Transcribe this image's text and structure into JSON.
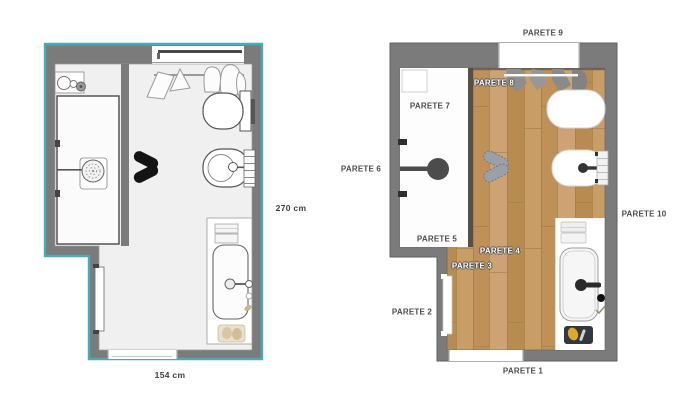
{
  "title": "Bathroom floor plan - 2D and rendered top views",
  "colors": {
    "selection_teal": "#45acb8",
    "wall_gray": "#7b7b7b",
    "floor_2d": "#f0f0f0",
    "wood_base": "#c69d68",
    "label_dark": "#4c4c4c",
    "shower_head_dark": "#4c4c4c"
  },
  "left_plan": {
    "type": "2d-floor-plan",
    "height_label": "270 cm",
    "width_label": "154 cm",
    "fixtures": [
      "window",
      "wall-niche",
      "shower",
      "shower-head",
      "hanging-towels",
      "toilet",
      "bidet",
      "towel-radiator",
      "vanity-counter",
      "towels",
      "sink",
      "faucet",
      "bath-mat",
      "door",
      "door-opening",
      "slippers"
    ]
  },
  "right_plan": {
    "type": "rendered-floor-plan",
    "wall_labels": {
      "p1": "PARETE 1",
      "p2": "PARETE 2",
      "p3": "PARETE 3",
      "p4": "PARETE 4",
      "p5": "PARETE 5",
      "p6": "PARETE 6",
      "p7": "PARETE 7",
      "p8": "PARETE 8",
      "p9": "PARETE 9",
      "p10": "PARETE 10"
    },
    "fixtures": [
      "window-opening",
      "wall-niche",
      "shower",
      "shower-head",
      "hanging-towels",
      "toilet",
      "bidet",
      "towel-radiator",
      "vanity-counter",
      "towels",
      "sink",
      "faucet",
      "bath-mat",
      "door",
      "door-opening",
      "slippers"
    ]
  }
}
